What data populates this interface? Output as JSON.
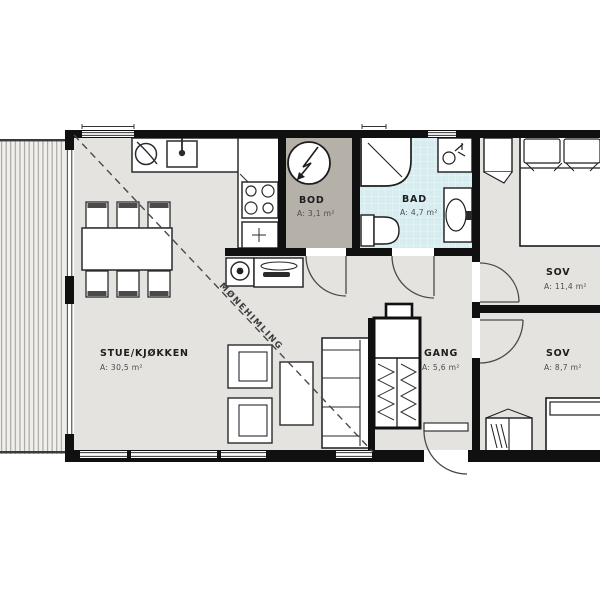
{
  "plan_type": "apartment-floor-plan",
  "rooms": [
    {
      "id": "stue-kjokken",
      "name": "STUE/KJØKKEN",
      "area": "A: 30,5 m²"
    },
    {
      "id": "bod",
      "name": "BOD",
      "area": "A: 3,1 m²"
    },
    {
      "id": "bad",
      "name": "BAD",
      "area": "A: 4,7 m²"
    },
    {
      "id": "sov-1",
      "name": "SOV",
      "area": "A: 11,4 m²"
    },
    {
      "id": "sov-2",
      "name": "SOV",
      "area": "A: 8,7 m²"
    },
    {
      "id": "gang",
      "name": "GANG",
      "area": "A: 5,6 m²"
    }
  ],
  "annotations": {
    "ridge_line_label": "MØNEHIMLING"
  },
  "colors": {
    "wall": "#101010",
    "floor": "#e4e3df",
    "storage_floor": "#b6b1a8",
    "bathroom_floor": "#d6ecef",
    "deck": "#f0efec",
    "furniture_outline": "#2b2b2b",
    "background": "#ffffff"
  }
}
